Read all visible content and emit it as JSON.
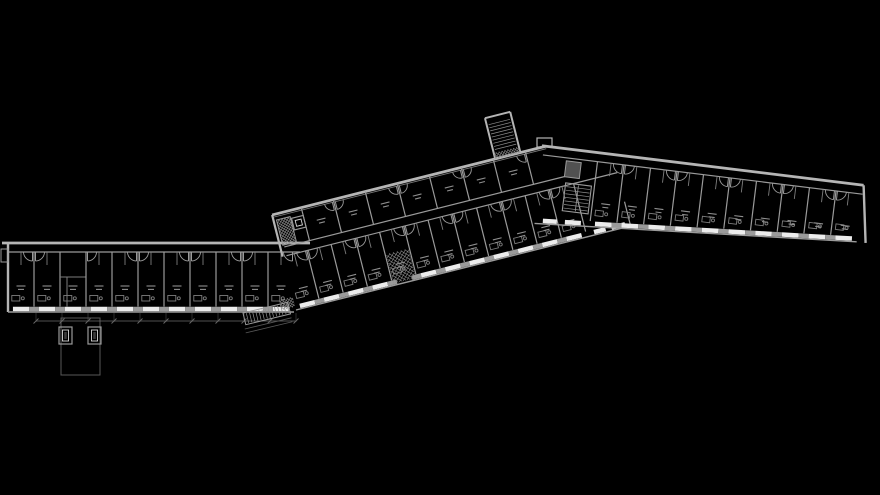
{
  "scene": {
    "width": 880,
    "height": 495,
    "background": "#000000",
    "drawing_type": "architectural-floor-plan",
    "room_label_style": "illegible-two-line-marks"
  },
  "colors": {
    "bg": "#000000",
    "wallOuter": "#b5b5b5",
    "wall": "#9a9a9a",
    "wallThin": "#7d7d7d",
    "window": "#ececec",
    "label": "#8f8f8f",
    "hatch": "#8f8f8f",
    "dim": "#6a6a6a",
    "ext": "#585858",
    "shaftFill": "#515151",
    "shaftInner": "#d6d6d6",
    "shaftDark": "#3a3a3a"
  },
  "wings": {
    "west": {
      "origin": [
        8,
        243
      ],
      "angle": 0,
      "length": 286,
      "corridor_depth": 9,
      "room_bottom": 69,
      "modules": 11,
      "module_width": 26,
      "no_door_modules": [
        2
      ]
    },
    "center": {
      "origin": [
        296,
        310
      ],
      "angle": -14.1,
      "lower": {
        "x0": 0,
        "modules": 12,
        "module_width": 25,
        "room_top": -55,
        "edge": 0,
        "crosshatch_module": 4,
        "lobby_end": 345
      },
      "corridor": {
        "top": -64,
        "bottom": -55,
        "x0": 4,
        "x1": 345
      },
      "upper": {
        "x0": 30,
        "modules": 7,
        "module_width": 33,
        "wall_y": -98,
        "inner_y": -95.5,
        "bottom": -64,
        "x_end": 282
      },
      "end_stair": {
        "x": 3,
        "y": -92,
        "w": 14,
        "h": 26
      },
      "end_shaft": {
        "x": 18,
        "y": -90,
        "w": 12,
        "h": 12
      },
      "tower": {
        "x": 230,
        "w": 26,
        "y_top": -140,
        "y_base": -98
      }
    },
    "east": {
      "origin": [
        544,
        146
      ],
      "angle": 7,
      "length": 322,
      "corridor_depth": 9,
      "rooms_x0": 55,
      "modules": 10,
      "module_width": 26.7,
      "depth_start": 78,
      "depth_end": 57,
      "end_wall": [
        322,
        0,
        331,
        57
      ],
      "junction": {
        "elevator": [
          24,
          12,
          15,
          16
        ],
        "stair": [
          26,
          20,
          26,
          28
        ],
        "lobby_x1": 55
      }
    }
  },
  "site": {
    "terrace": {
      "x": 61,
      "y": 318,
      "w": 39,
      "h": 57
    },
    "shaft_boxes": [
      {
        "x": 59,
        "y": 327,
        "w": 13,
        "h": 17
      },
      {
        "x": 88,
        "y": 327,
        "w": 13,
        "h": 17
      }
    ],
    "dimension_line": {
      "y": 321,
      "x0": 36,
      "x1": 296,
      "tick_spacing": 26,
      "ticks": 11
    },
    "exterior_stair": {
      "x": 243,
      "y": 313,
      "angle": -13.5,
      "len": 46,
      "w": 12
    },
    "corner_hatch": {
      "x": 38,
      "y": -4,
      "w": 14,
      "h": 10
    },
    "porch": {
      "x": 1,
      "y": 249,
      "w": 7,
      "h": 13
    },
    "apex_notch": {
      "x": 537,
      "y": 138,
      "w": 15,
      "h": 9
    }
  },
  "room_style": {
    "door_radius": 9,
    "sill_inset_frac": 0.19,
    "sill_weight": 4.5,
    "label_line_widths": [
      9,
      6
    ],
    "stub_len": 13
  }
}
